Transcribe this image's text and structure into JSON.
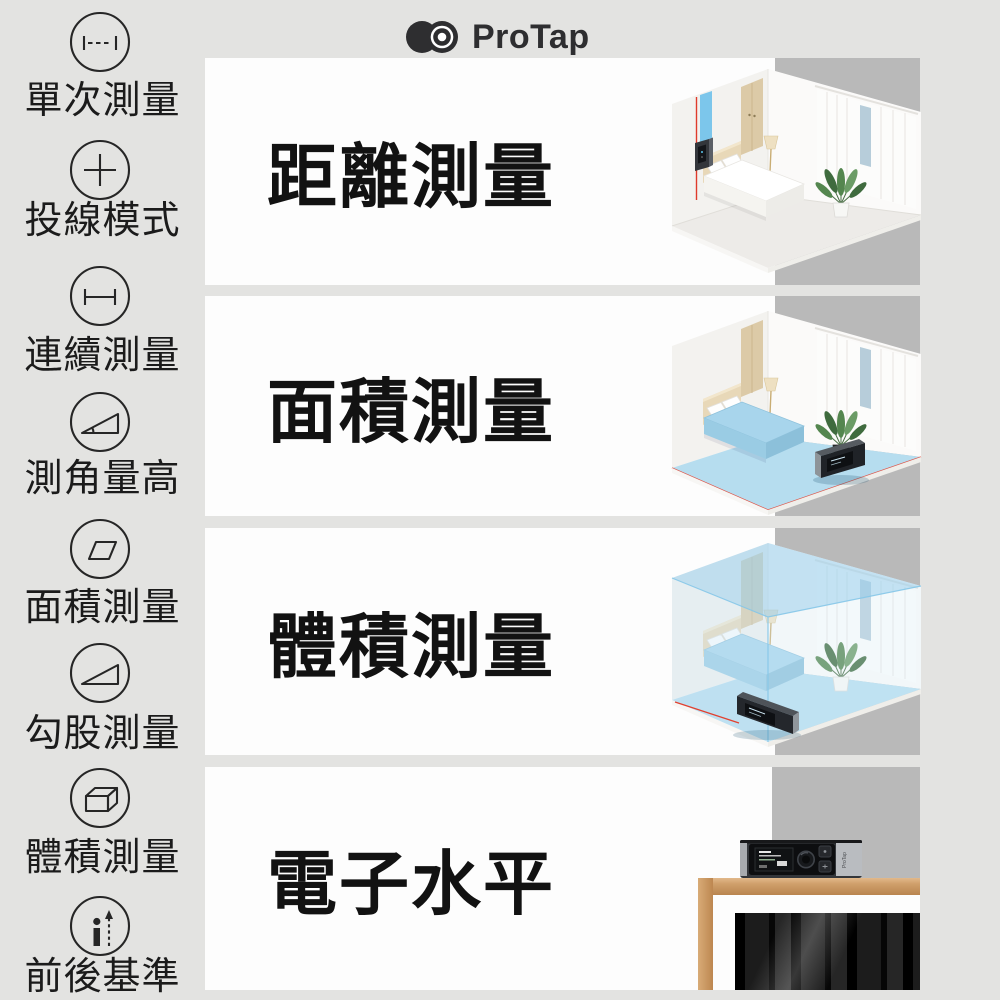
{
  "brand": {
    "name": "ProTap"
  },
  "colors": {
    "background": "#e3e3e1",
    "panel": "#fdfdfd",
    "stripe": "#b9b9b9",
    "title_text": "#121212",
    "accent_blue_beam": "#72c2ea",
    "floor_highlight_blue": "#b6ddef",
    "laser_red": "#df3a2b",
    "wood_frame": "#c89b6a",
    "logo_dark": "#2e2e30"
  },
  "sidebar": {
    "items": [
      {
        "label": "單次測量",
        "icon": "single-measure-icon"
      },
      {
        "label": "投線模式",
        "icon": "line-projection-icon"
      },
      {
        "label": "連續測量",
        "icon": "continuous-measure-icon"
      },
      {
        "label": "測角量高",
        "icon": "angle-height-icon"
      },
      {
        "label": "面積測量",
        "icon": "area-measure-icon"
      },
      {
        "label": "勾股測量",
        "icon": "pythagoras-icon"
      },
      {
        "label": "體積測量",
        "icon": "volume-measure-icon"
      },
      {
        "label": "前後基準",
        "icon": "front-rear-datum-icon"
      }
    ]
  },
  "rows": [
    {
      "title": "距離測量",
      "illustration": "bedroom-distance-laser"
    },
    {
      "title": "面積測量",
      "illustration": "bedroom-floor-area"
    },
    {
      "title": "體積測量",
      "illustration": "bedroom-volume-box"
    },
    {
      "title": "電子水平",
      "illustration": "device-level-on-frame"
    }
  ]
}
